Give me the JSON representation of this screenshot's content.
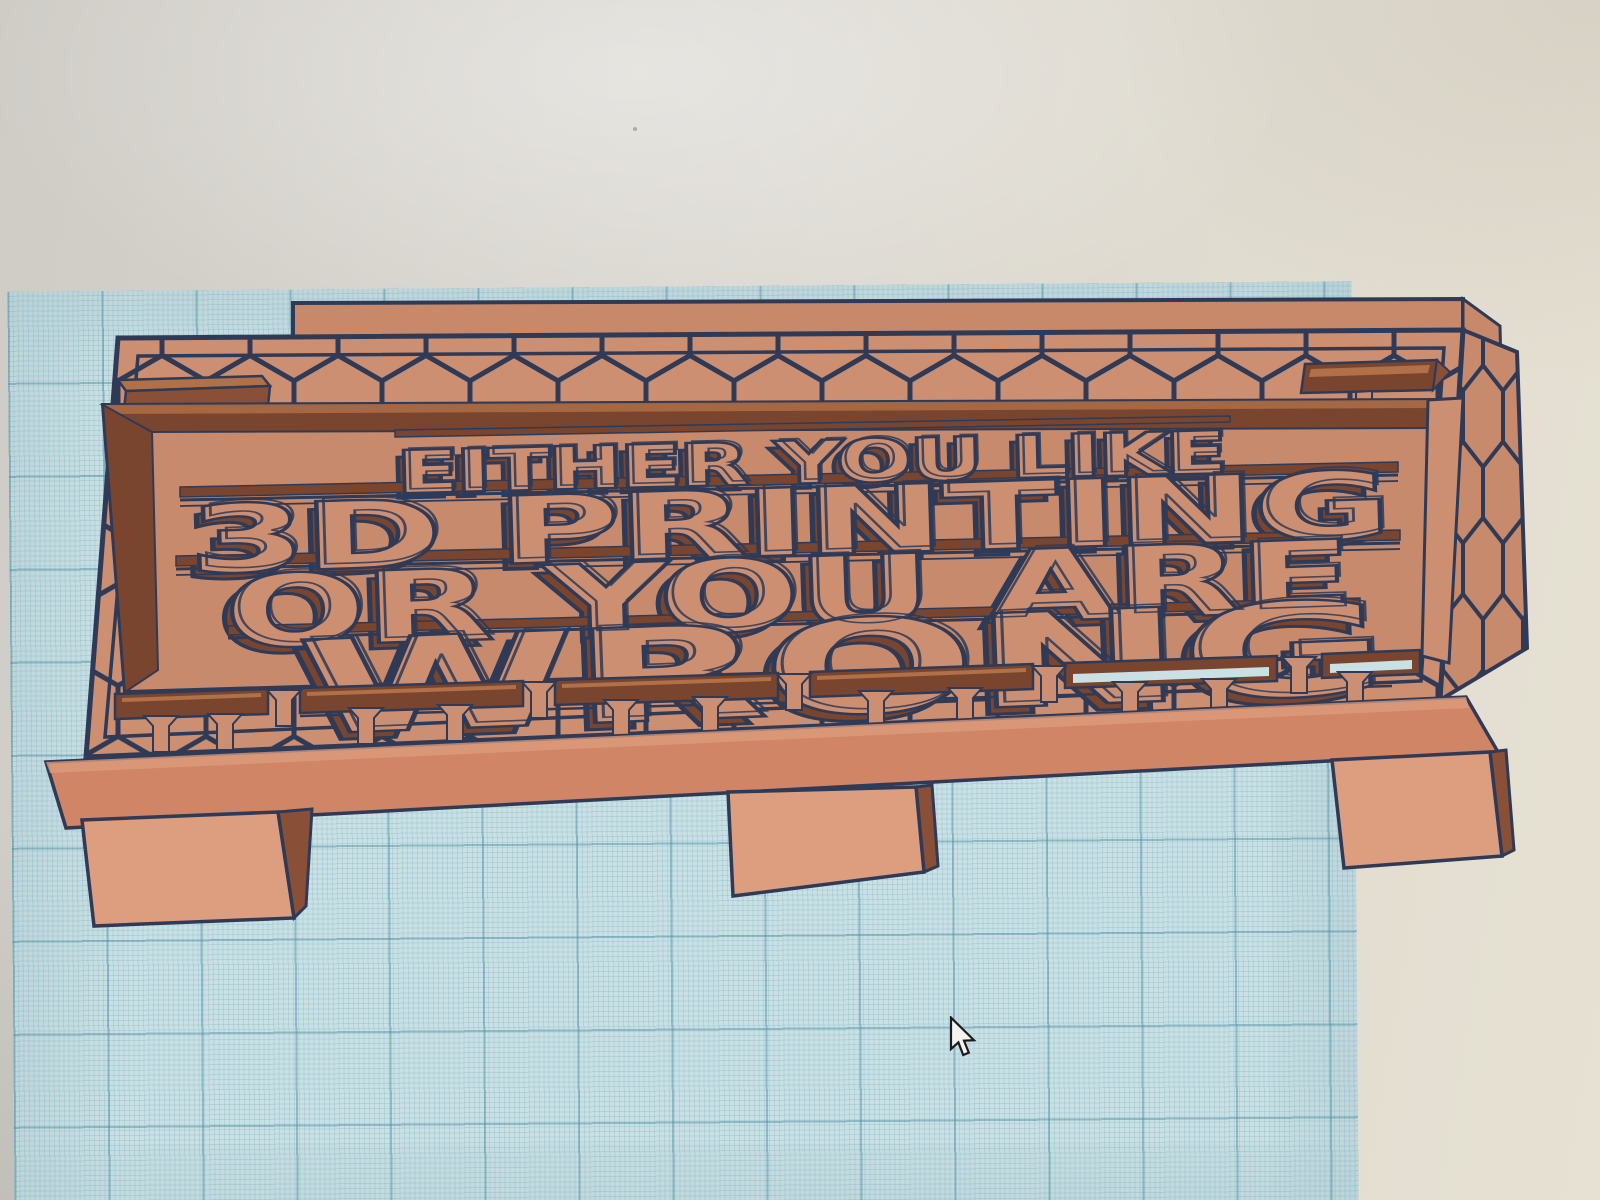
{
  "scene": {
    "description_context": "photographed 3D-design workplane with a carved sign model and mouse pointer",
    "sign": {
      "lines": [
        "EITHER YOU LIKE",
        "3D PRINTING",
        "OR YOU ARE",
        "WRONG"
      ]
    },
    "cursor": "arrow-pointer",
    "colors": {
      "model_face": "#cd8f71",
      "model_face_dark": "#c78a6c",
      "model_face_light": "#dd9d7f",
      "model_back": "#c8896b",
      "model_base": "#cf8566",
      "model_side": "#8a4f37",
      "model_recess": "#7a452f",
      "slot_top_light": "#b07148",
      "outline": "#2f3a56",
      "plane_base": "#c9e0e4",
      "plane_fine": "rgba(125,175,190,0.28)",
      "plane_major": "rgba(70,140,160,0.45)",
      "bg_left": "#cfccc6",
      "bg_mid": "#dad7d0",
      "bg_right": "#e2ddd0",
      "bg_far": "#e6e1d3",
      "cursor_fill": "#f4f3f1",
      "cursor_outline": "#1c1c1c"
    }
  }
}
